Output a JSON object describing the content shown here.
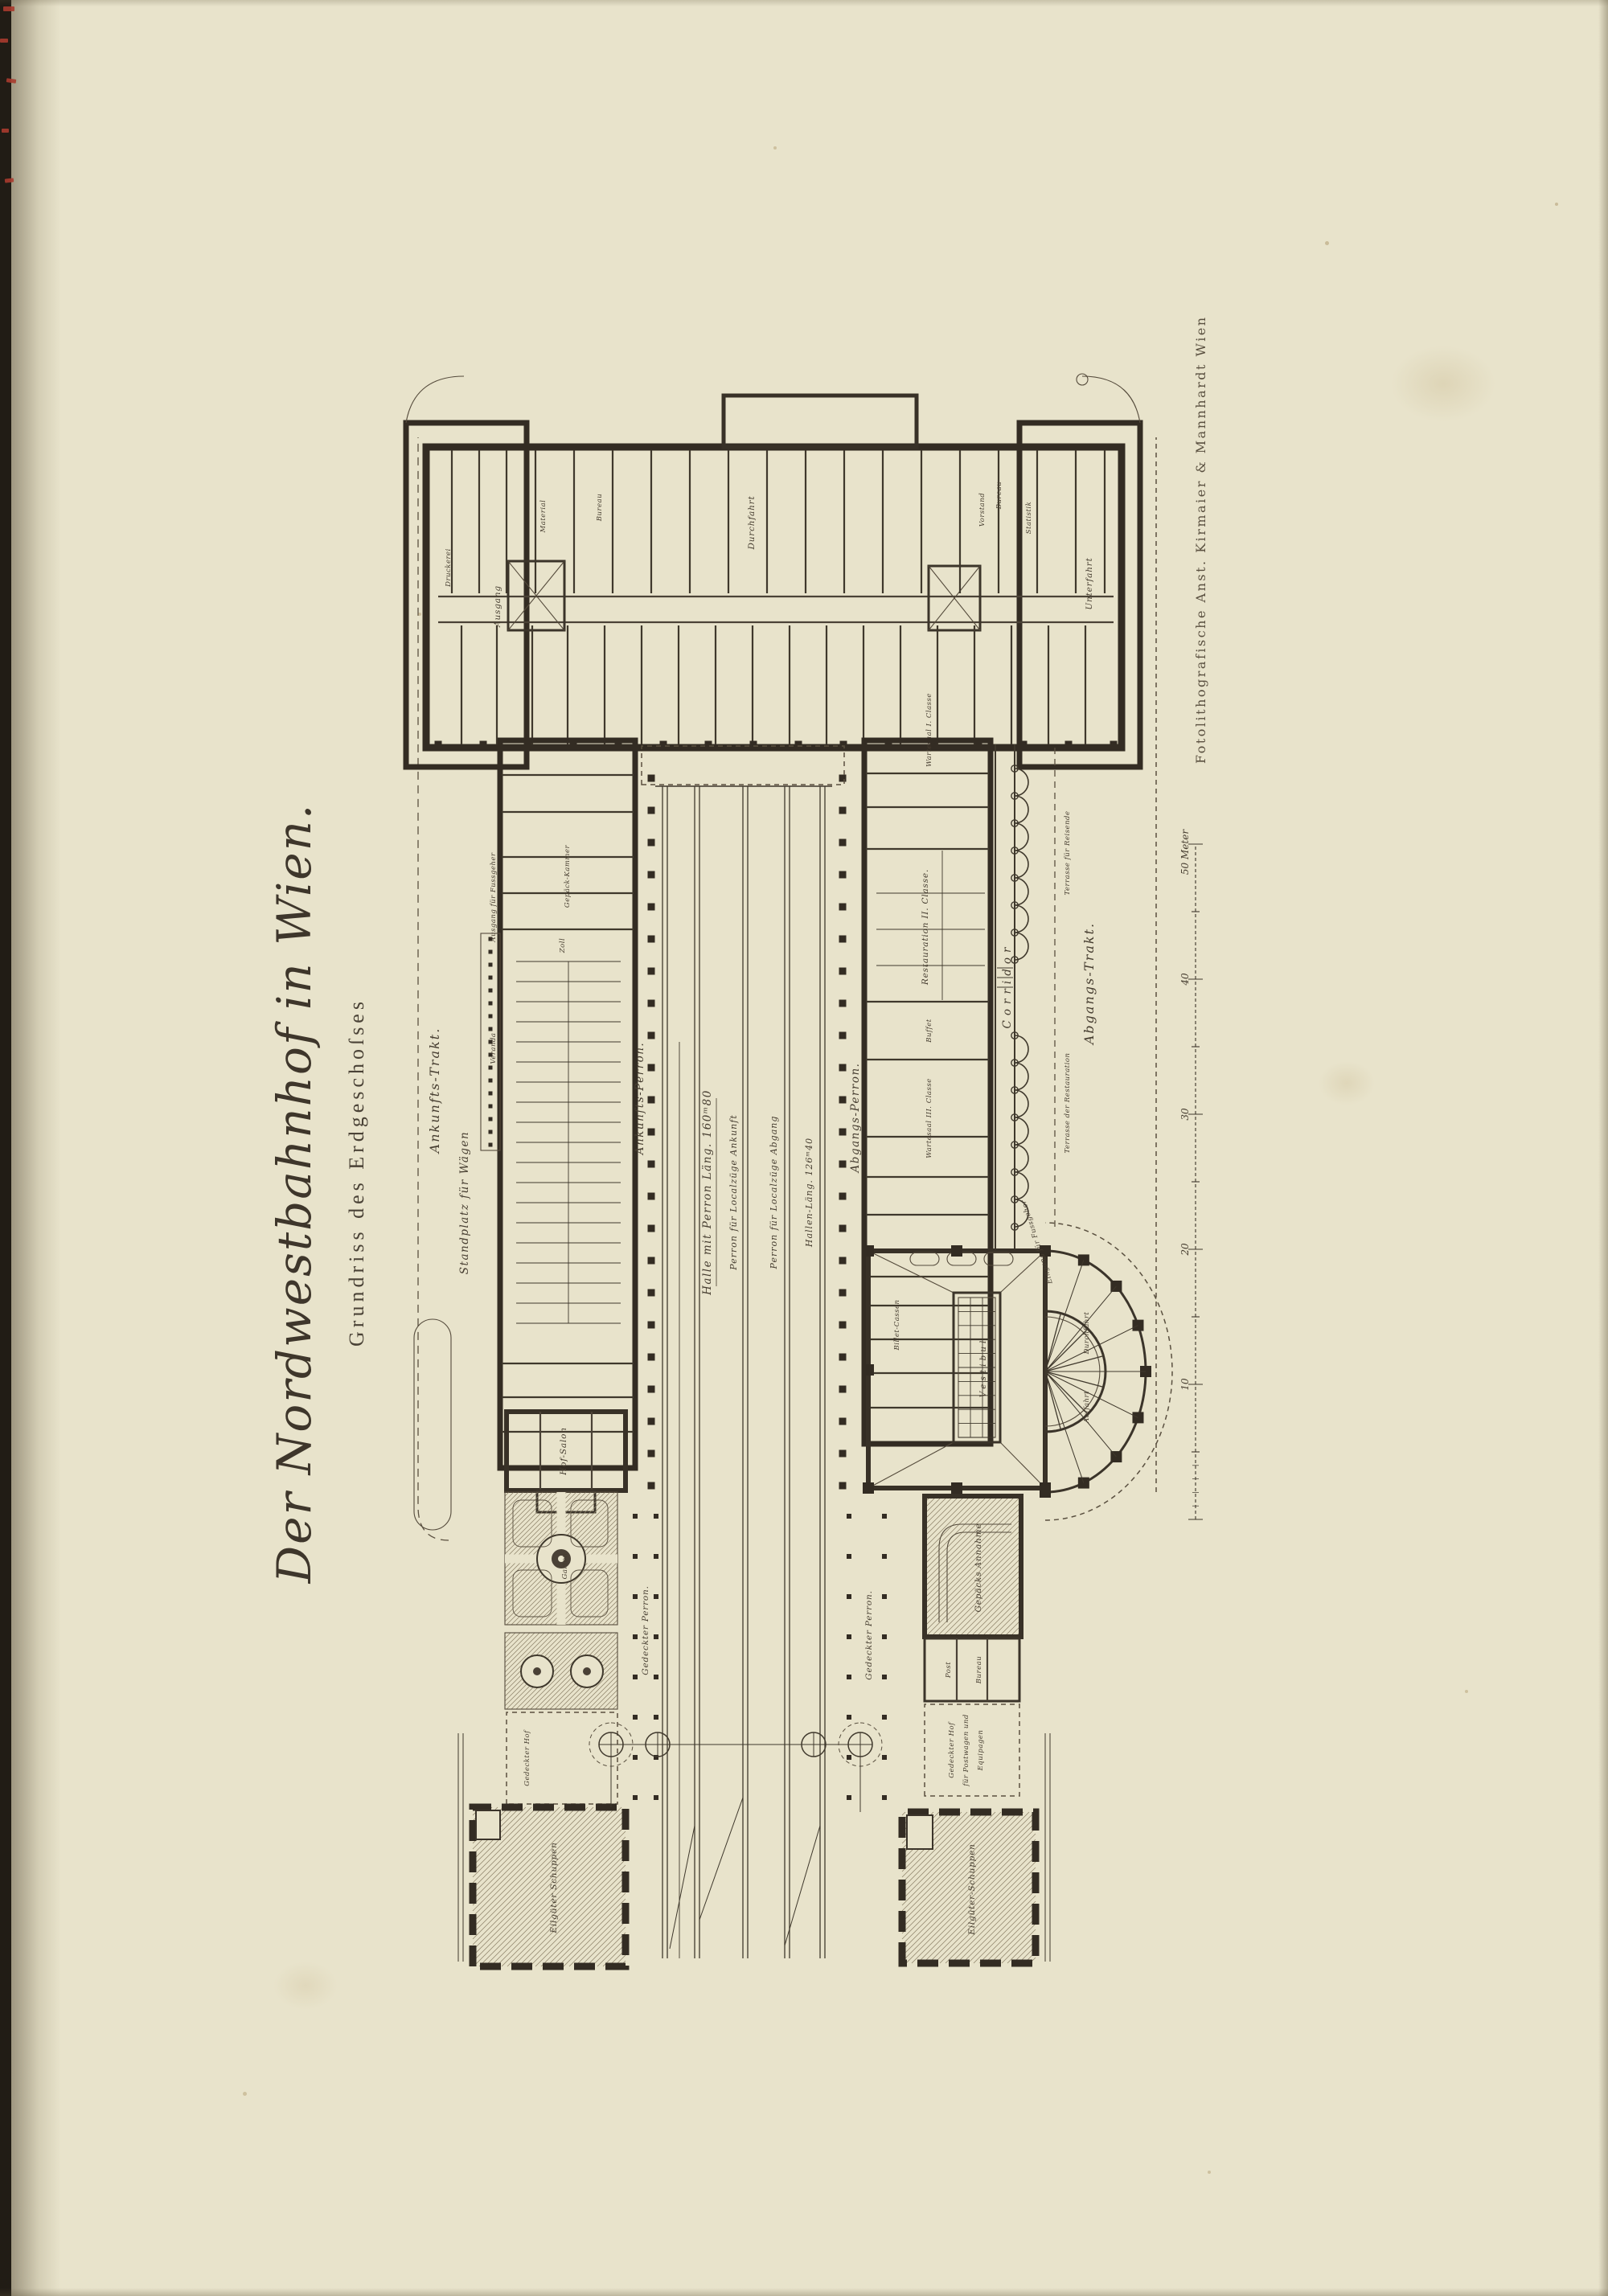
{
  "page": {
    "paper_color": "#e8e3cb",
    "ink_color": "#3f382c",
    "binding_mark_color": "#a93b2e"
  },
  "plate": {
    "title": "Der Nordwestbahnhof in Wien.",
    "subtitle": "Grundriss des Erdgeschoſses",
    "imprint": "Fotolithografische Anst. Kirmaier & Mannhardt Wien",
    "scale_bar": {
      "labels": [
        "10",
        "20",
        "30",
        "40",
        "50 Meter"
      ]
    },
    "labels": {
      "ankunfts_trakt": "Ankunfts-Trakt.",
      "standplatz": "Standplatz für Wägen",
      "veranda": "Veranda",
      "ausgang_fussgeher": "Ausgang für Fussgeher",
      "ankunfts_perron": "Ankunfts-Perron.",
      "halle_mit_perron": "Halle mit Perron Läng. 160ᵐ80",
      "perron_localzuege_ankunft": "Perron für Localzüge Ankunft",
      "perron_localzuege_abgang": "Perron für Localzüge Abgang",
      "hallen_laeng": "Hallen-Läng. 126ᵐ40",
      "abgangs_perron": "Abgangs-Perron.",
      "corridor": "Corridor",
      "terrasse_reisende": "Terrasse für Reisende",
      "terrasse_restauration": "Terrasse der Restauration",
      "abgangs_trakt": "Abgangs-Trakt.",
      "restauration_2": "Restauration II. Classe.",
      "buffet": "Buffet",
      "wartesaal_3": "Wartesaal III. Classe",
      "wartesaal_1": "Wartesaal I. Classe",
      "billet_cassen": "Billet-Cassen",
      "vestibul": "Vestibul",
      "durchfahrt_rotunde": "Durchfahrt",
      "auffahrt": "Auffahrt",
      "eingang_fussgeher": "Eingang für Fussgeher",
      "gepaecks_annahme": "Gepäcks Annahme",
      "post": "Post",
      "bureau": "Bureau",
      "gedeckter_hof": "Gedeckter Hof",
      "hof_postwagen_1": "Gedeckter Hof",
      "hof_postwagen_2": "für Postwagen und",
      "hof_postwagen_3": "Equipagen",
      "eilgueter_schuppen_1": "Eilgüter Schuppen",
      "eilgueter_schuppen_2": "Eilgüter-Schuppen",
      "gedeckter_perron": "Gedeckter Perron.",
      "hof_salon": "Hof-Salon",
      "garten": "Garten",
      "ausgang": "Ausgang",
      "durchfahrt_kopf": "Durchfahrt",
      "unterfahrt": "Unterfahrt",
      "statistik": "Statistik",
      "vorstand": "Vorstand",
      "druckerei": "Druckerei",
      "material": "Material",
      "zoll": "Zoll",
      "gepaeck_kammer": "Gepäck-Kammer"
    }
  }
}
